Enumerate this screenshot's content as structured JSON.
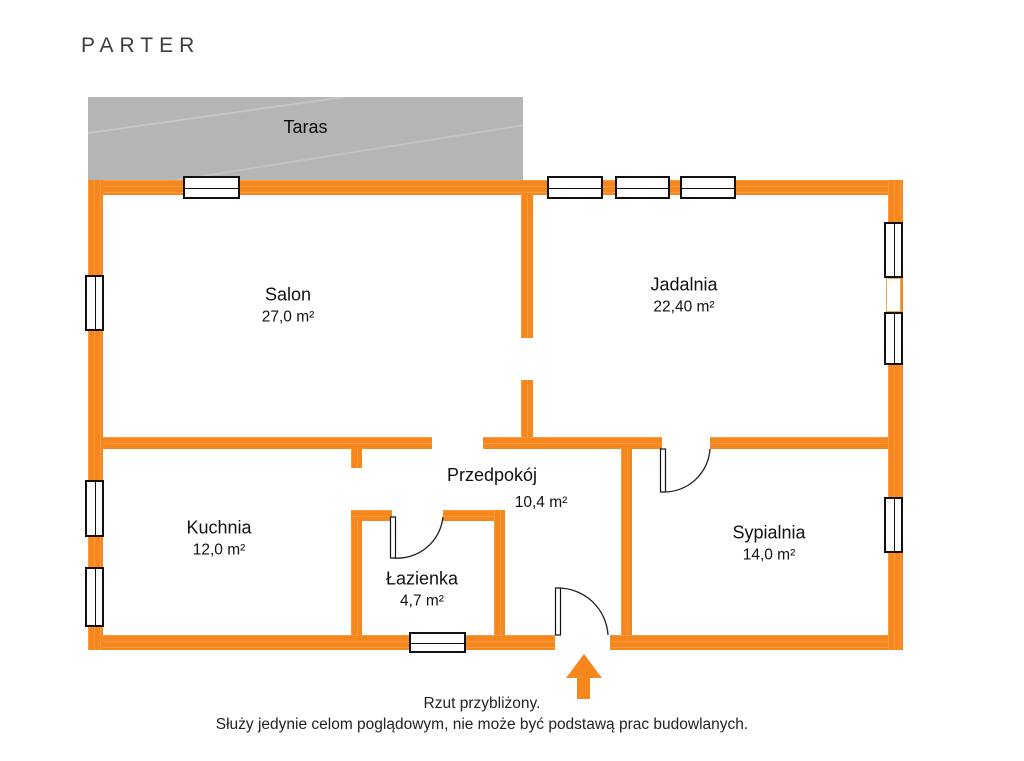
{
  "title": "PARTER",
  "colors": {
    "wall": "#F6871D",
    "terrace": "#B5B5B5",
    "text": "#111111",
    "title_color": "#3D3D3D",
    "footer_color": "#222222",
    "win_border": "#111111",
    "mullion_border": "#F0A45A"
  },
  "terrace": {
    "label": "Taras"
  },
  "rooms": [
    {
      "id": "salon",
      "name": "Salon",
      "area": "27,0 m²"
    },
    {
      "id": "jadalnia",
      "name": "Jadalnia",
      "area": "22,40 m²"
    },
    {
      "id": "kuchnia",
      "name": "Kuchnia",
      "area": "12,0 m²"
    },
    {
      "id": "przedpokoj",
      "name": "Przedpokój",
      "area": "10,4 m²"
    },
    {
      "id": "lazienka",
      "name": "Łazienka",
      "area": "4,7 m²"
    },
    {
      "id": "sypialnia",
      "name": "Sypialnia",
      "area": "14,0 m²"
    }
  ],
  "footer": {
    "line1": "Rzut przybliżony.",
    "line2": "Służy jedynie celom poglądowym, nie może być podstawą prac budowlanych."
  },
  "icons": {
    "entrance_arrow": "arrow-up"
  }
}
